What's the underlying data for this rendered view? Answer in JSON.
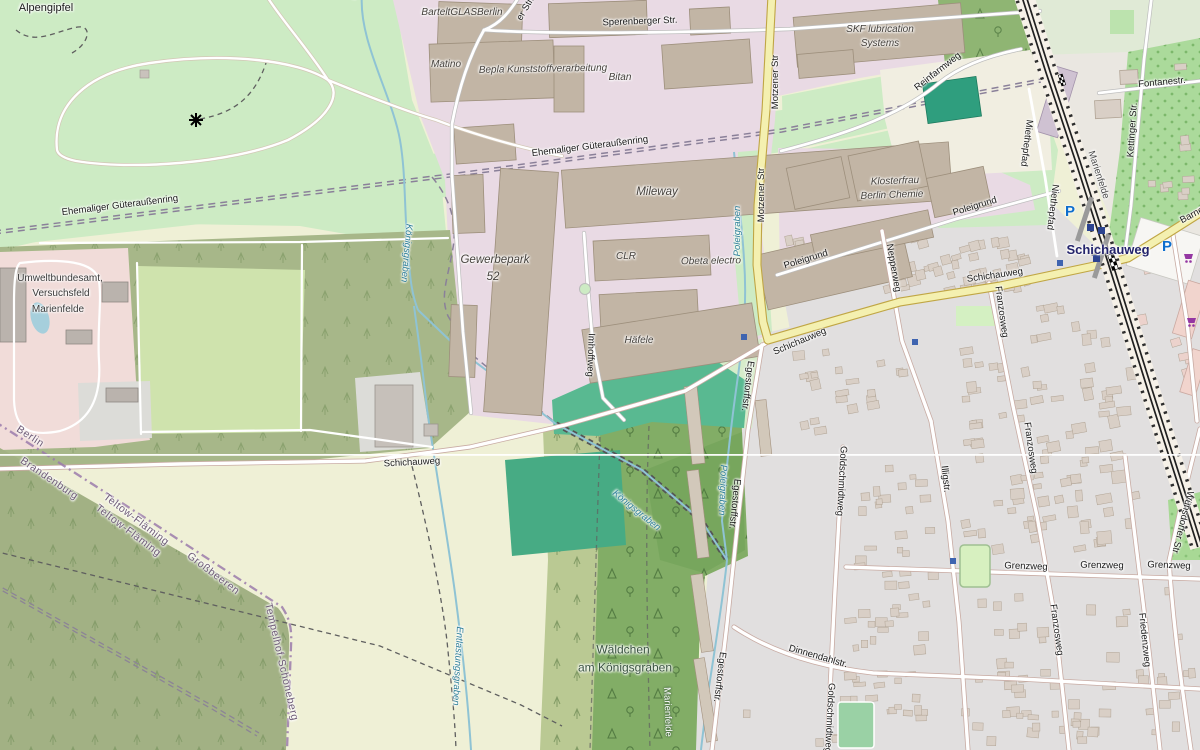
{
  "map": {
    "source_style": "OpenStreetMap Carto extract",
    "area": "Berlin Marienfelde / Lichtenrade around S Schichauweg",
    "colors": {
      "park_green": "#cdebc4",
      "scrub_olive": "#a7b789",
      "forest_green": "#82ad66",
      "farmland_cream": "#eff0d6",
      "industrial_lavender": "#e9dae4",
      "residential_grey": "#e1dfdf",
      "orchard_green": "#abda9b",
      "meadow_green": "#cfe3ad",
      "basin_teal": "#47ab84",
      "basin_emerald": "#59b991",
      "water_blue": "#8fc3d4",
      "secondary_road_yellow": "#f4f0b0",
      "building_tan": "#d9cfc6",
      "building_industrial": "#c2b5a5",
      "railway_dark": "#2e2e2e",
      "boundary_purple": "#9b7bab",
      "parking_blue": "#0d6ecd",
      "supermarket_purple": "#9437a2",
      "station_label_navy": "#23236b",
      "water_label_teal": "#2e7f99",
      "admin_label_purple": "#6d5a76"
    }
  },
  "labels": {
    "places": {
      "alpengipfel": "Alpengipfel",
      "umweltbundesamt_line1": "Umweltbundesamt,",
      "umweltbundesamt_line2": "Versuchsfeld",
      "umweltbundesamt_line3": "Marienfelde",
      "bartelt": "BarteltGLASBerlin",
      "matino": "Matino",
      "bepla": "Bepla Kunststoffverarbeitung",
      "bitan": "Bitan",
      "skf_line1": "SKF lubrication",
      "skf_line2": "Systems",
      "mileway": "Mileway",
      "gewerbepark_line1": "Gewerbepark",
      "gewerbepark_line2": "52",
      "clr": "CLR",
      "obeta": "Obeta electro",
      "haefele": "Häfele",
      "klosterfrau_line1": "Klosterfrau",
      "klosterfrau_line2": "Berlin Chemie",
      "waeldchen_line1": "Wäldchen",
      "waeldchen_line2": "am Königsgraben",
      "marienfelde_forest": "Marienfelde",
      "marienfelde_rail": "Marienfelde"
    },
    "streets": {
      "ehemaliger_gueteraussenring": "Ehemaliger Güteraußenring",
      "sperenberger": "Sperenberger Str.",
      "sperenberger_partial": "er Str.",
      "motzener": "Motzener Str",
      "reinfarmweg": "Reinfarmweg",
      "poleigrund": "Poleigrund",
      "schichauweg": "Schichauweg",
      "egestorffstr": "Egestorffstr.",
      "imhoffweg": "Imhoffweg",
      "miethepfad": "Miethepfad",
      "niethepfad": "Niethepfad",
      "fontanestr": "Fontanestr.",
      "kettinger": "Kettinger Str.",
      "barnetstr": "Barnetstr.",
      "nepperweg": "Nepperweg",
      "franzosweg": "Franzosweg",
      "goldschmidtweg": "Goldschmidtweg",
      "illigstr": "Illigstr.",
      "grenzweg": "Grenzweg",
      "friedenzweg": "Friedenzweg",
      "dinnendahlstr": "Dinnendahlstr.",
      "wuensdorfer": "Wünsdorfer Str"
    },
    "water": {
      "koenigsgraben": "Königsgraben",
      "poleigraben": "Poleigraben",
      "entlastungsgraben": "Entlastungsgraben"
    },
    "admin": {
      "berlin": "Berlin",
      "brandenburg": "Brandenburg",
      "teltow_flaeming": "Teltow-Fläming",
      "grossbeeren": "Großbeeren",
      "tempelhof_schoeneberg": "Tempelhof-Schöneberg"
    },
    "transit": {
      "station_schichauweg": "Schichauweg"
    },
    "icons": {
      "parking": "P"
    }
  }
}
